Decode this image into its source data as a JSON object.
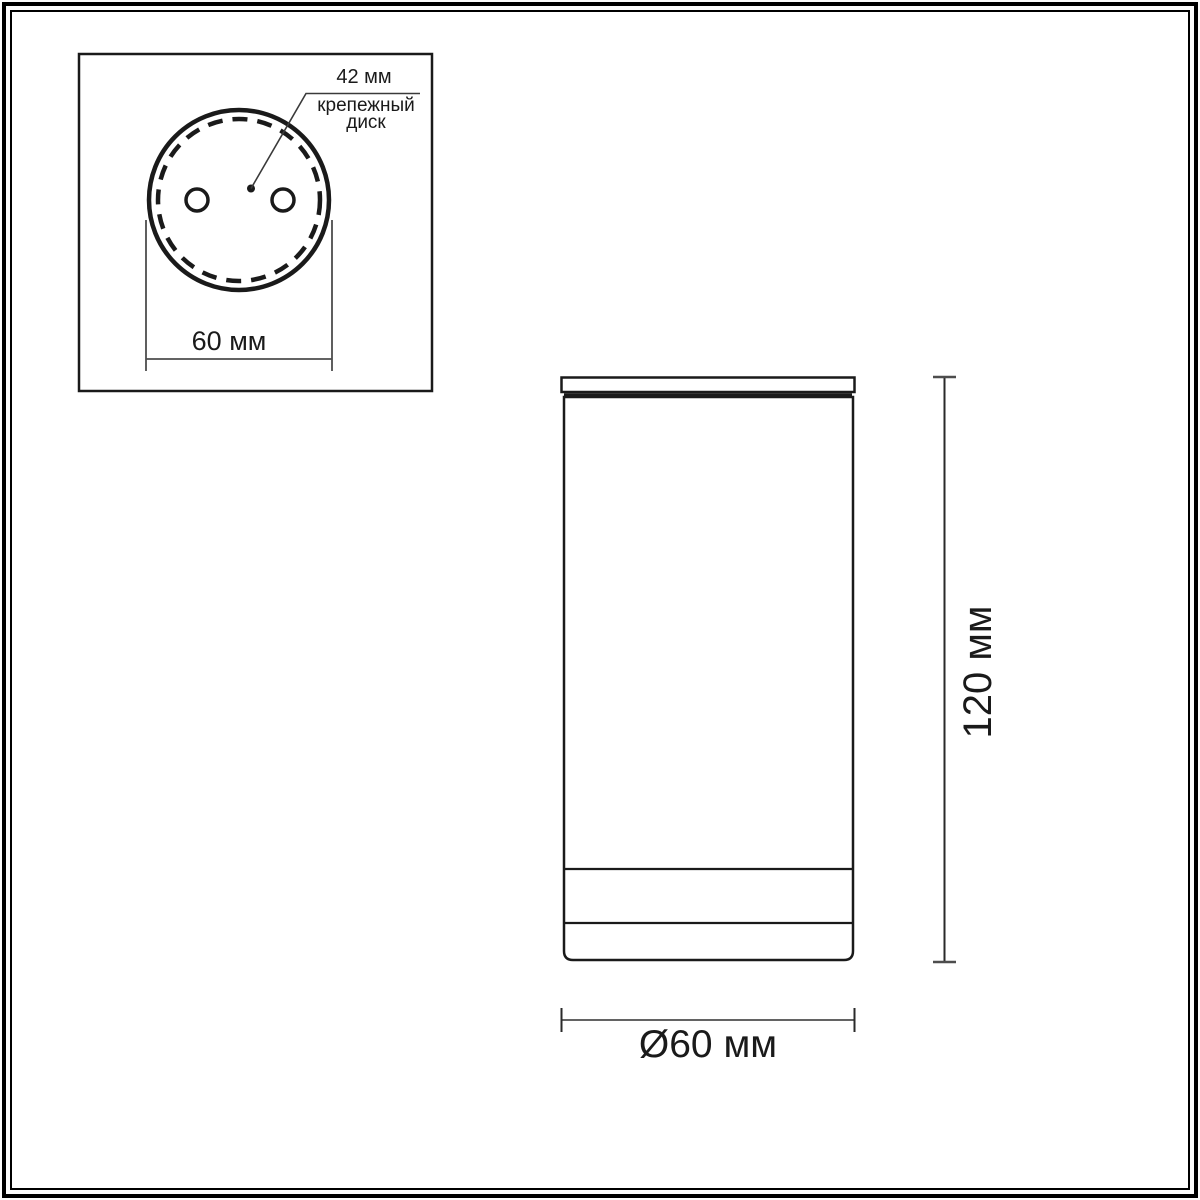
{
  "drawing": {
    "kind": "technical-dimension-drawing",
    "inset": {
      "disc_diameter_label": "42 мм",
      "disc_caption": {
        "line1": "крепежный",
        "line2": "диск"
      },
      "base_diameter_label": "60 мм"
    },
    "side_view": {
      "height_label": "120 мм",
      "diameter_label": "Ø60 мм"
    },
    "colors": {
      "background": "#ffffff",
      "ink": "#1a1a1a",
      "dimension_line": "#4d4d4d",
      "frame": "#000000"
    }
  }
}
